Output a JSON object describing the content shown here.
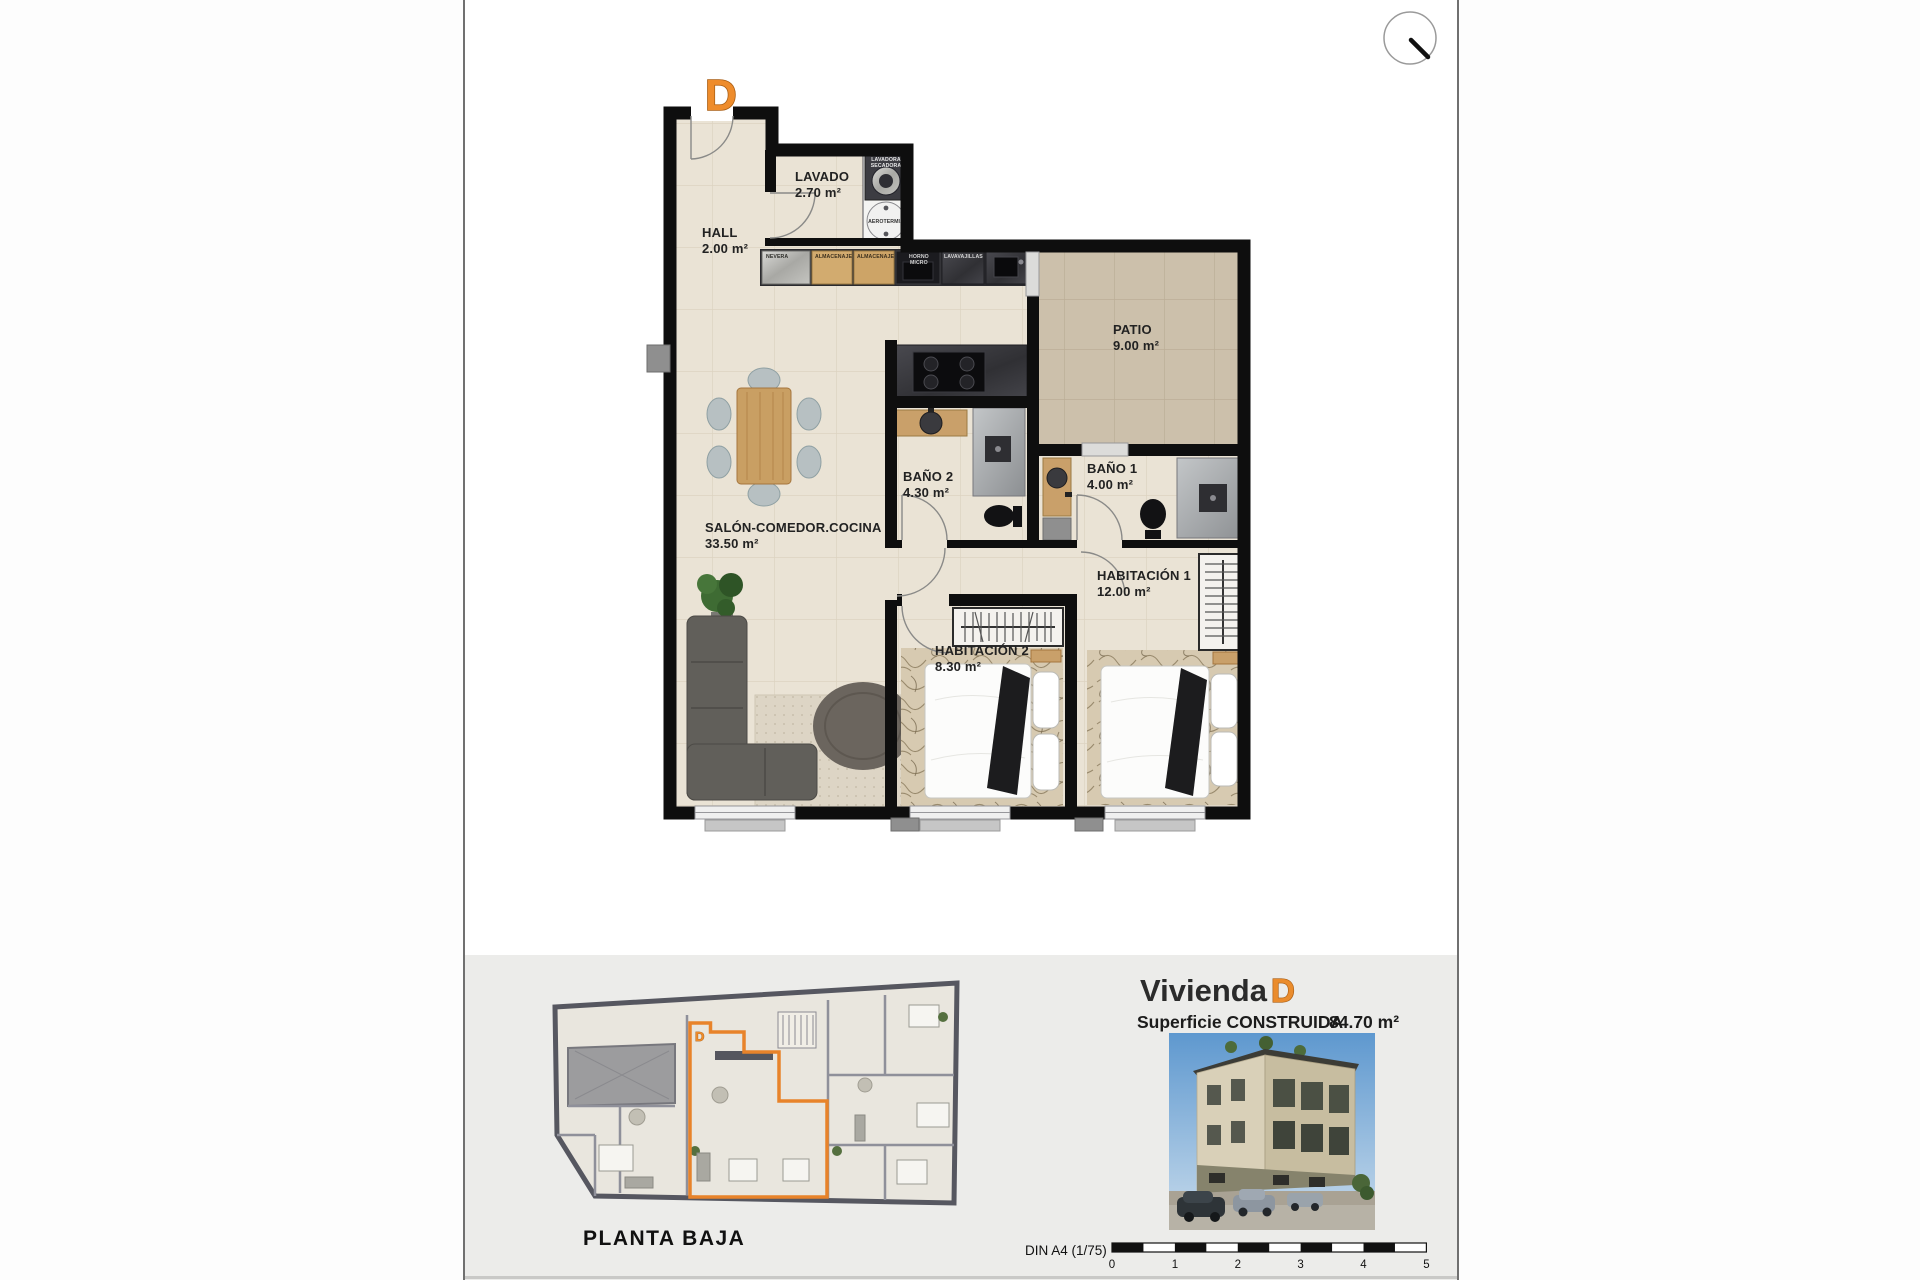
{
  "accent_color": "#e8832a",
  "plan": {
    "unit_letter": "D",
    "rooms": {
      "hall": {
        "name": "HALL",
        "area": "2.00 m²"
      },
      "lavado": {
        "name": "LAVADO",
        "area": "2.70 m²"
      },
      "patio": {
        "name": "PATIO",
        "area": "9.00 m²"
      },
      "salon": {
        "name": "SALÓN-COMEDOR.COCINA",
        "area": "33.50 m²"
      },
      "bano2": {
        "name": "BAÑO 2",
        "area": "4.30 m²"
      },
      "bano1": {
        "name": "BAÑO 1",
        "area": "4.00 m²"
      },
      "habitacion1": {
        "name": "HABITACIÓN 1",
        "area": "12.00 m²"
      },
      "habitacion2": {
        "name": "HABITACIÓN 2",
        "area": "8.30 m²"
      }
    },
    "appliances": {
      "nevera": "NEVERA",
      "almacenaje1": "ALMACENAJE",
      "almacenaje2": "ALMACENAJE",
      "horno_line1": "HORNO",
      "horno_line2": "MICRO",
      "lavavajillas": "LAVAVAJILLAS",
      "lavadora_line1": "LAVADORA",
      "lavadora_line2": "SECADORA",
      "aerotermia": "AEROTERMIA"
    }
  },
  "footer": {
    "overview": {
      "title": "PLANTA BAJA",
      "unit_letter": "D"
    },
    "unit": {
      "title_prefix": "Vivienda",
      "title_letter": "D",
      "surface_label": "Superficie CONSTRUIDA",
      "surface_value": "84.70 m²"
    },
    "scale": {
      "label": "DIN A4 (1/75)",
      "ticks": [
        "0",
        "1",
        "2",
        "3",
        "4",
        "5"
      ]
    }
  }
}
